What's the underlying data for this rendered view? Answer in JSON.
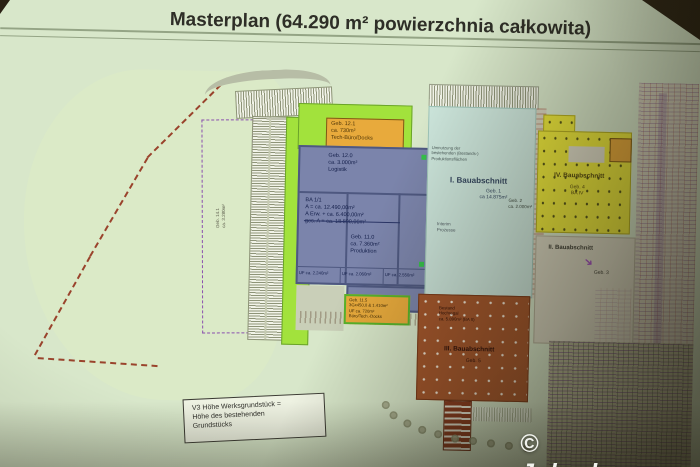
{
  "watermark": "© Jelonka.com",
  "slide": {
    "title": "Masterplan (64.290 m² powierzchnia całkowita)"
  },
  "plan": {
    "left_strip": "Geb. 14.1\nca. 3.280m²",
    "geb121": "Geb. 12.1\nca. 730m²\nTech-Büro/Docks",
    "blue": {
      "geb12": "Geb. 12.0\nca. 3.000m²\nLogistik",
      "ba11": "BA 1/1\nA =        ca. 12.490,00m²\nA Erw. +  ca. 6.400,00m²\nges. A =  ca. 18.890,00m²",
      "geb11": "Geb. 11.0\nca. 7.360m²\nProduktion",
      "uf": [
        "UF ca. 2.240m²",
        "UF ca. 2.060m²",
        "UF ca. 2.550m²"
      ]
    },
    "geb115": "Geb. 11.5\n3Gx450,0 & 1.410m²\nUF ca. 720m²\nBüro/Tech.-Docks",
    "ba1": {
      "note": "Umnutzung der\nbestehenden (Bestands-)\nProduktionsflächen",
      "label": "I. Bauabschnitt",
      "sub": "Geb. 1\nca 14.875m²",
      "interim": "Interim\nProzesse"
    },
    "geb2": "Geb. 2\nca. 2.000m²",
    "ba4": {
      "label": "IV. Bauabschnitt",
      "sub": "Geb. 4\nBA IV"
    },
    "ba2": {
      "label": "II. Bauabschnitt",
      "sub": "Geb. 3"
    },
    "ba3": {
      "note": "Bestand\nHochregal\nca. 5.890m² (BA II)",
      "label": "III. Bauabschnitt",
      "sub": "Geb. 5"
    },
    "legend": "V3 Höhe Werksgrundstück =\nHöhe des bestehenden\nGrundstücks"
  }
}
